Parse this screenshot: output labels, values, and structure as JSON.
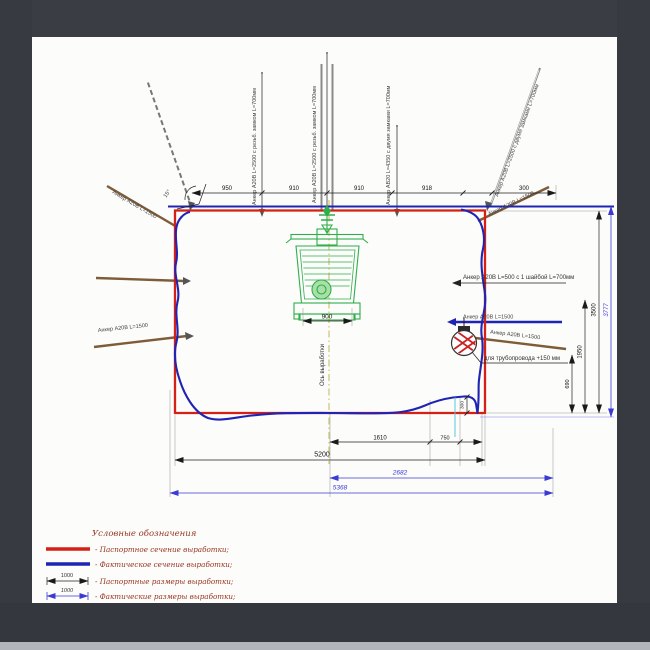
{
  "colors": {
    "passport_section": "#d42015",
    "actual_section": "#1f24b4",
    "actual_dim": "#3b3bd4",
    "equipment": "#2fae4a",
    "anchor_steel": "#8a8a8a",
    "anchor_wood": "#7d5c37",
    "centerline": "#c9b458",
    "bezel": "#3a3d44",
    "bezel_strip": "#b2b5ba",
    "paper": "#fcfcfb"
  },
  "labels": {
    "anchor_roof_1": "Анкер А20В L=2500 с резьб. замком L=700мм",
    "anchor_roof_2": "Анкер А20В L=2500 с резьб. замком L=700мм",
    "anchor_roof_3": "Анкер АВ20 L=4350 с двумя замками L=700мм",
    "anchor_roof_incl": "Анкер А20В L=2500 с двумя замками L=700мм",
    "anchor_top_left": "Анкер А20В L=1500",
    "anchor_left_low": "Анкер А20В L=1500",
    "anchor_top_right": "Анкер А20В L=1500",
    "anchor_right_wall": "Анкер А20В L=500 с 1 шайбой L=700мм",
    "anchor_right_blue": "Анкер А20В L=1500",
    "anchor_right_brown": "Анкер А20В L=1500",
    "pipe_note": "для трубопровода +150 мм",
    "axis": "Ось выработки",
    "angle": "15°"
  },
  "dims": {
    "top": [
      "950",
      "910",
      "910",
      "918",
      "300"
    ],
    "equip_width": "900",
    "b1610": "1610",
    "b750": "750",
    "b5200": "5200",
    "b2682": "2682",
    "b5368": "5368",
    "r690": "690",
    "r1950": "1950",
    "r3500": "3500",
    "r3777": "3777",
    "step300": "300"
  },
  "legend": {
    "title": "Условные обозначения",
    "items": [
      {
        "label": "- Паспортное сечение выработки;"
      },
      {
        "label": "- Фактическое сечение выработки;"
      },
      {
        "label": "- Паспортные размеры выработки;",
        "value": "1000"
      },
      {
        "label": "- Фактические размеры выработки;",
        "value": "1000"
      }
    ]
  }
}
